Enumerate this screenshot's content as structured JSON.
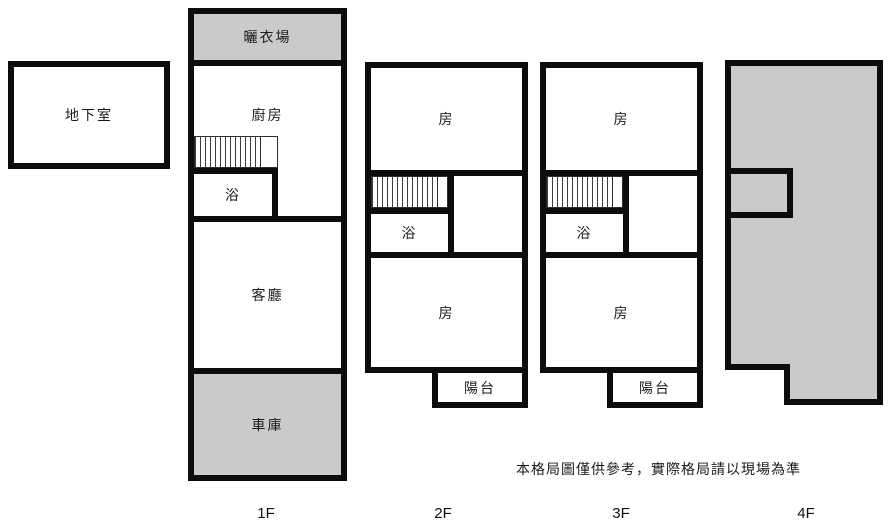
{
  "colors": {
    "wall": "#0c0c0c",
    "shaded_fill": "#cacaca",
    "background": "#ffffff"
  },
  "disclaimer": "本格局圖僅供參考，實際格局請以現場為準",
  "basement": {
    "name": "地下室"
  },
  "floors": {
    "f1": {
      "tag": "1F",
      "drying": "曬衣場",
      "kitchen": "廚房",
      "bath": "浴",
      "living": "客廳",
      "garage": "車庫"
    },
    "f2": {
      "tag": "2F",
      "room_top": "房",
      "bath": "浴",
      "room_bottom": "房",
      "balcony": "陽台"
    },
    "f3": {
      "tag": "3F",
      "room_top": "房",
      "bath": "浴",
      "room_bottom": "房",
      "balcony": "陽台"
    },
    "f4": {
      "tag": "4F"
    }
  }
}
